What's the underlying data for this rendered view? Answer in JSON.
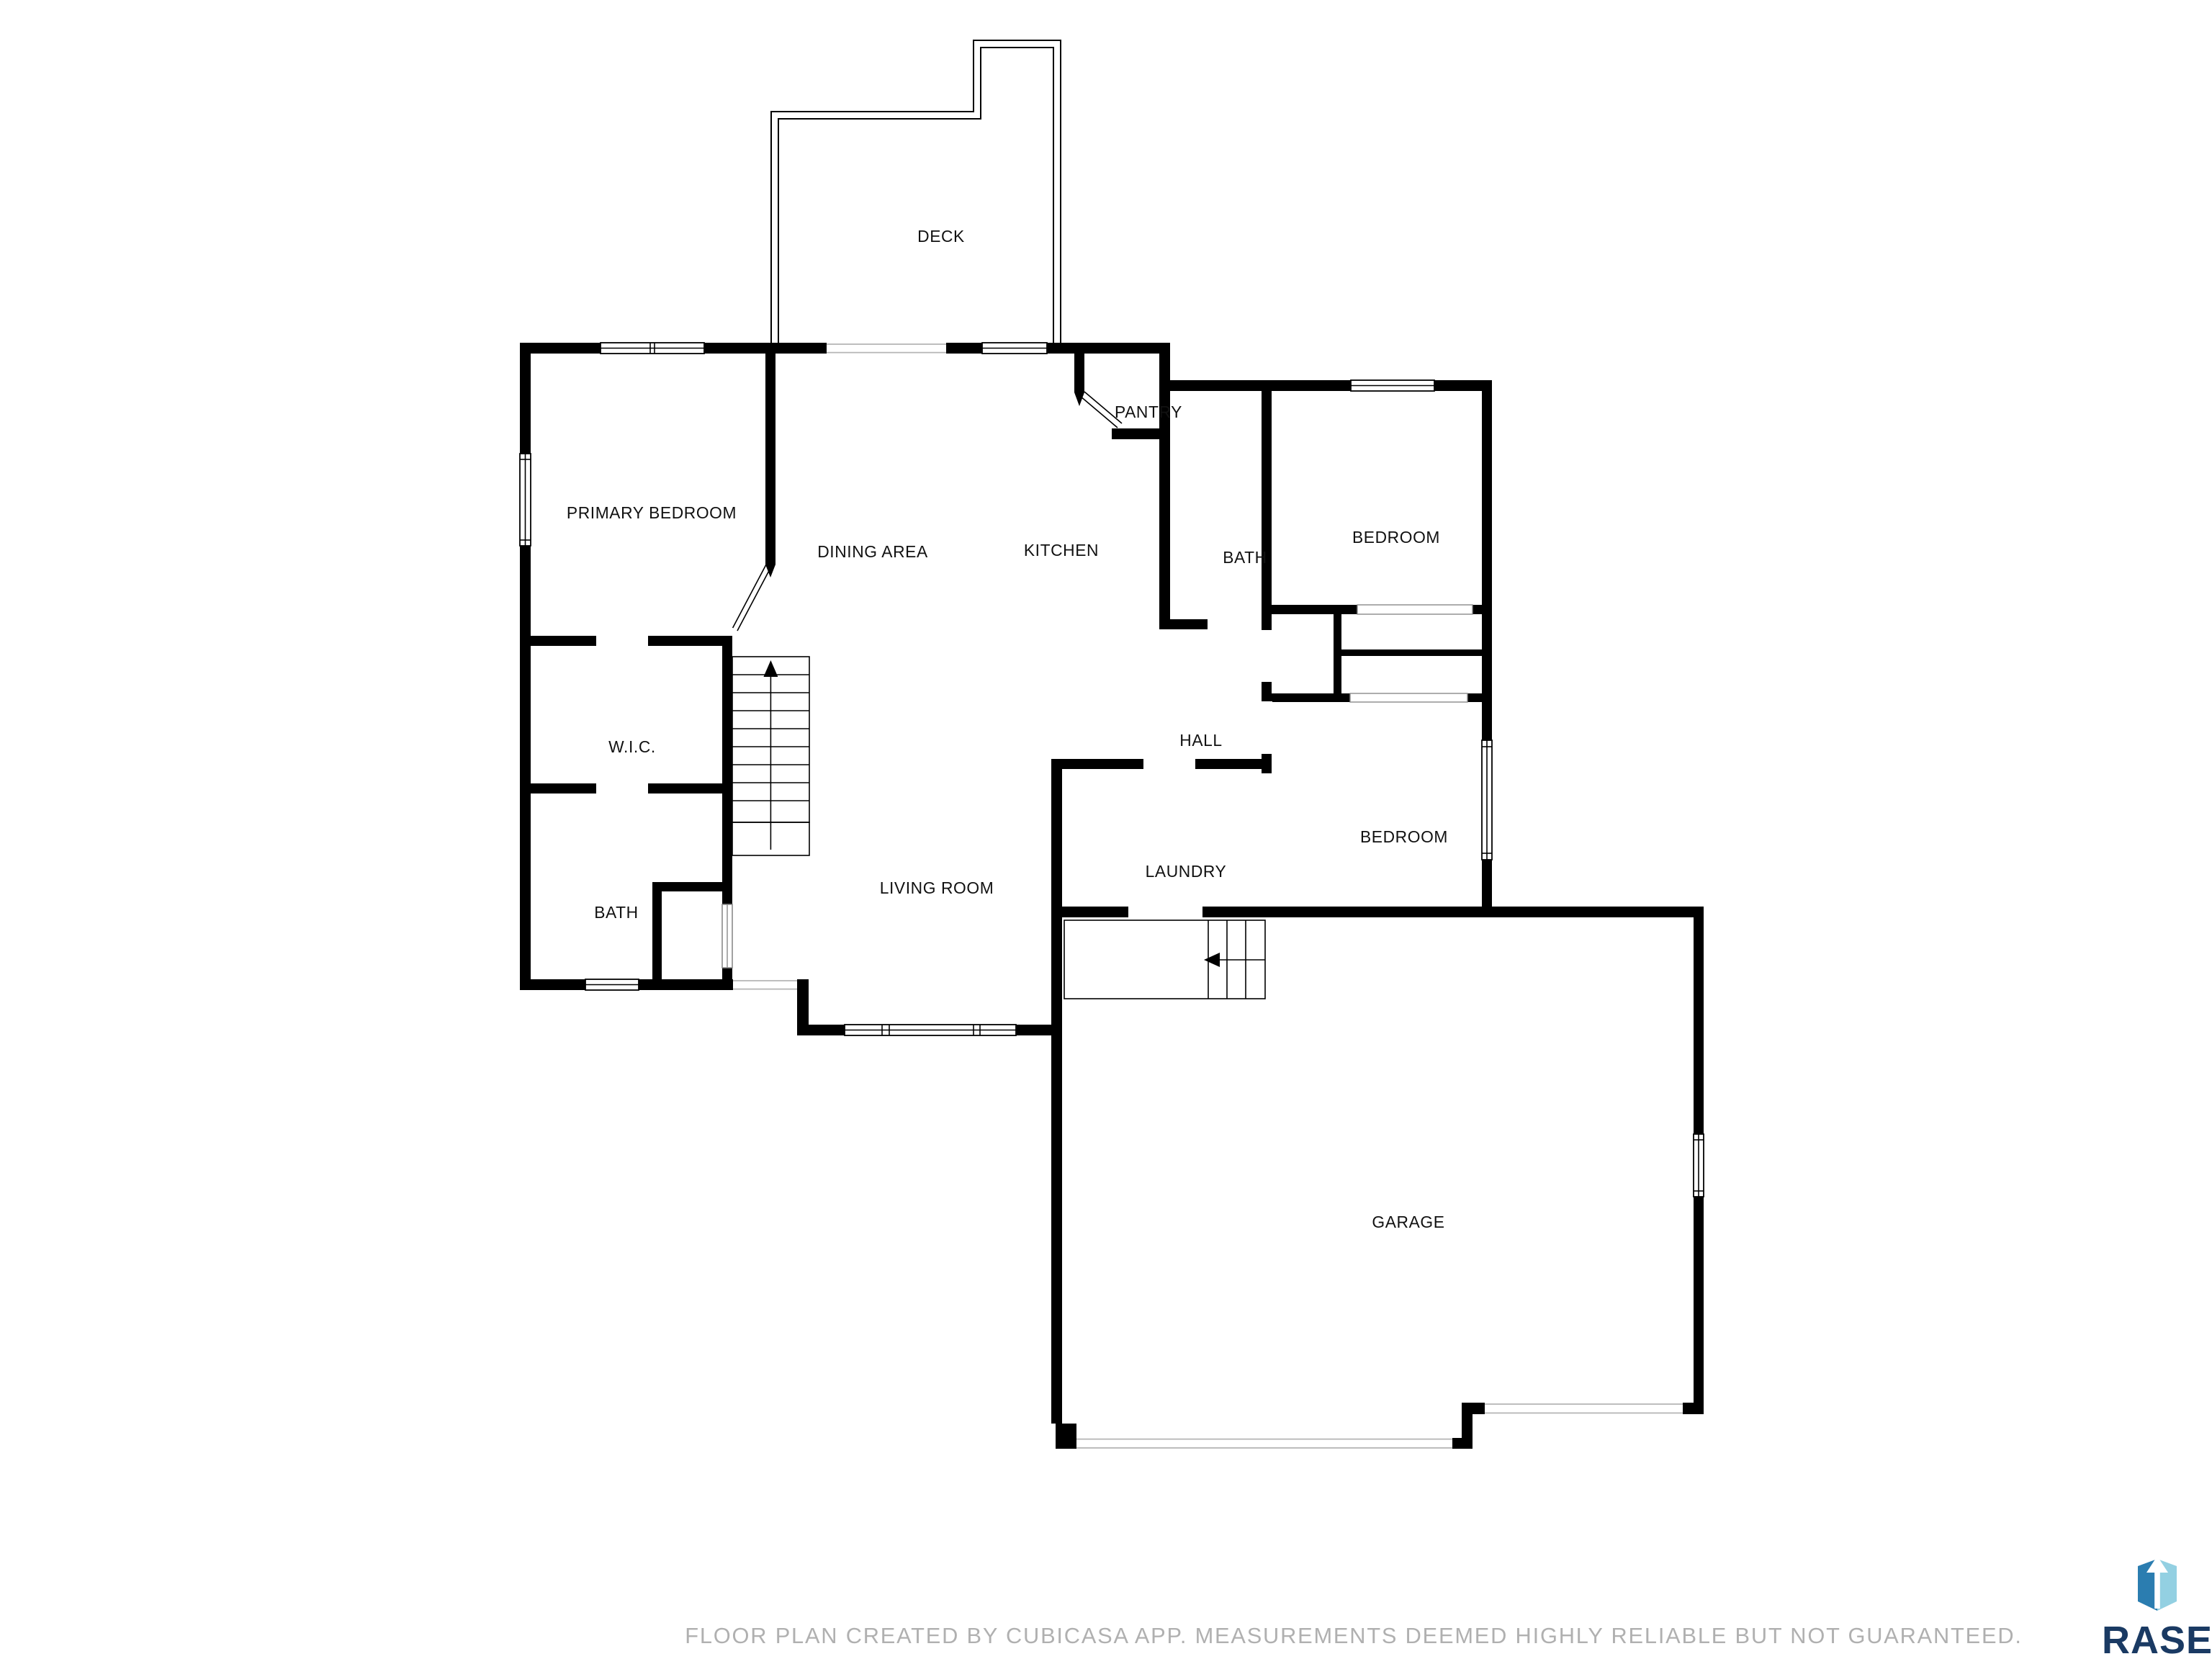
{
  "floor_plan": {
    "rooms": [
      {
        "id": "deck",
        "label": "DECK"
      },
      {
        "id": "primary-bedroom",
        "label": "PRIMARY BEDROOM"
      },
      {
        "id": "dining-area",
        "label": "DINING AREA"
      },
      {
        "id": "kitchen",
        "label": "KITCHEN"
      },
      {
        "id": "pantry",
        "label": "PANTRY"
      },
      {
        "id": "bath-upper",
        "label": "BATH"
      },
      {
        "id": "bedroom-upper",
        "label": "BEDROOM"
      },
      {
        "id": "wic",
        "label": "W.I.C."
      },
      {
        "id": "hall",
        "label": "HALL"
      },
      {
        "id": "bedroom-right",
        "label": "BEDROOM"
      },
      {
        "id": "laundry",
        "label": "LAUNDRY"
      },
      {
        "id": "living-room",
        "label": "LIVING ROOM"
      },
      {
        "id": "bath-lower",
        "label": "BATH"
      },
      {
        "id": "garage",
        "label": "GARAGE"
      }
    ],
    "footer_disclaimer": "FLOOR PLAN CREATED BY CUBICASA APP. MEASUREMENTS DEEMED HIGHLY RELIABLE BUT NOT GUARANTEED.",
    "branding": {
      "name": "RASE",
      "colors": {
        "wordmark": "#1a3a63",
        "icon_dark": "#2b7db0",
        "icon_light": "#93d0e2",
        "icon_arrow": "#ffffff"
      }
    },
    "colors": {
      "wall": "#000000",
      "background": "#ffffff",
      "opening_line": "#b5b5b5",
      "footer_text": "#b0b0b0"
    }
  }
}
